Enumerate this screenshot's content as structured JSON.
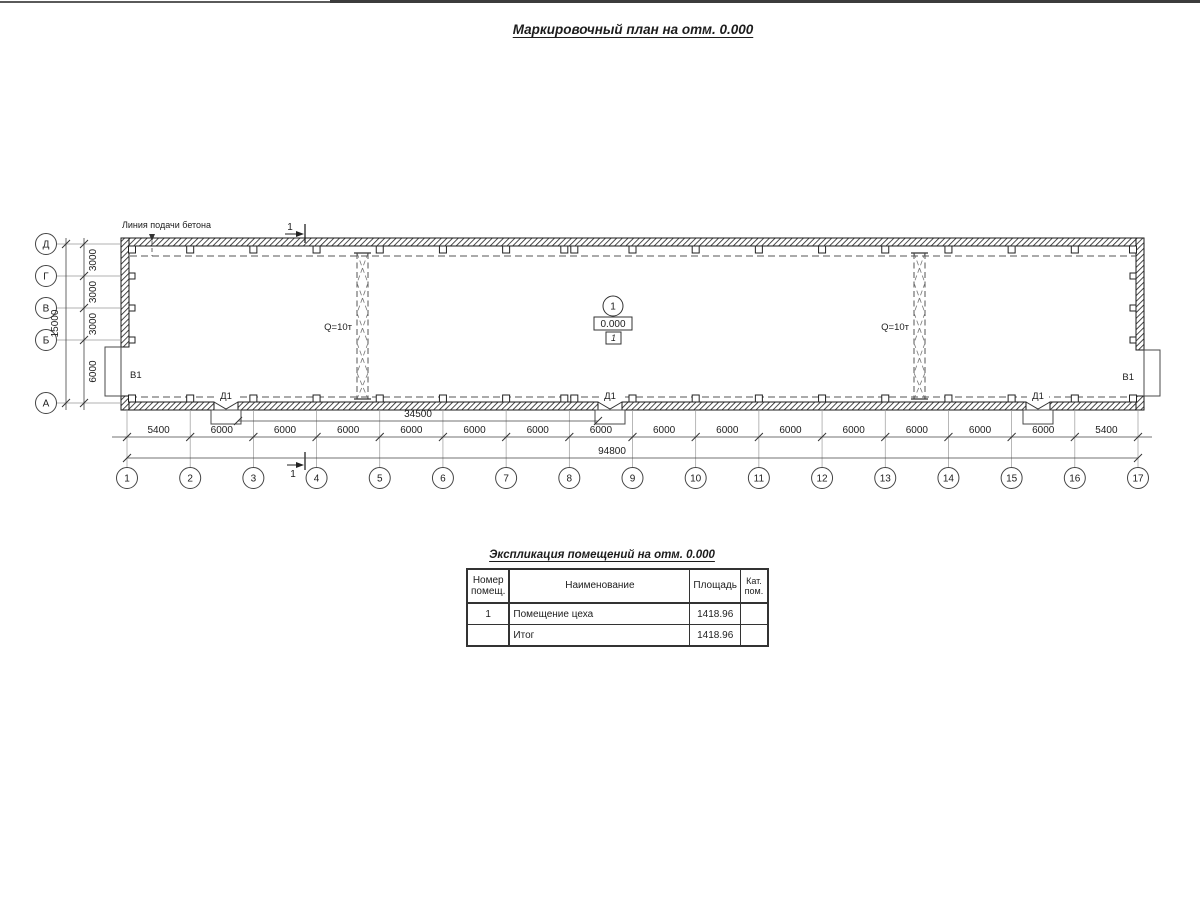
{
  "page": {
    "title_label": "Маркировочный план на отм. 0.000"
  },
  "plan": {
    "concrete_line_label": "Линия подачи бетона",
    "section_mark_label": "1",
    "crane_left_label": "Q=10т",
    "crane_right_label": "Q=10т",
    "gate_left_label": "В1",
    "gate_right_label": "В1",
    "door_label": "Д1",
    "room_marker": {
      "number": "1",
      "elevation": "0.000",
      "floor_mark": "1"
    },
    "axes_bottom": [
      "1",
      "2",
      "3",
      "4",
      "5",
      "6",
      "7",
      "8",
      "9",
      "10",
      "11",
      "12",
      "13",
      "14",
      "15",
      "16",
      "17"
    ],
    "axes_left": [
      "Д",
      "Г",
      "В",
      "Б",
      "А"
    ],
    "dims_bottom": [
      "5400",
      "6000",
      "6000",
      "6000",
      "6000",
      "6000",
      "6000",
      "6000",
      "6000",
      "6000",
      "6000",
      "6000",
      "6000",
      "6000",
      "6000",
      "5400"
    ],
    "dim_total": "94800",
    "dim_between_doors": "34500",
    "dims_left": [
      "3000",
      "3000",
      "3000",
      "6000"
    ],
    "dim_left_total": "15000"
  },
  "table": {
    "title": "Экспликация помещений на отм. 0.000",
    "headers": [
      "Номер помещ.",
      "Наименование",
      "Площадь",
      "Кат. пом."
    ],
    "rows": [
      {
        "number": "1",
        "name": "Помещение цеха",
        "area": "1418.96",
        "category": ""
      },
      {
        "number": "",
        "name": "Итог",
        "area": "1418.96",
        "category": ""
      }
    ]
  }
}
